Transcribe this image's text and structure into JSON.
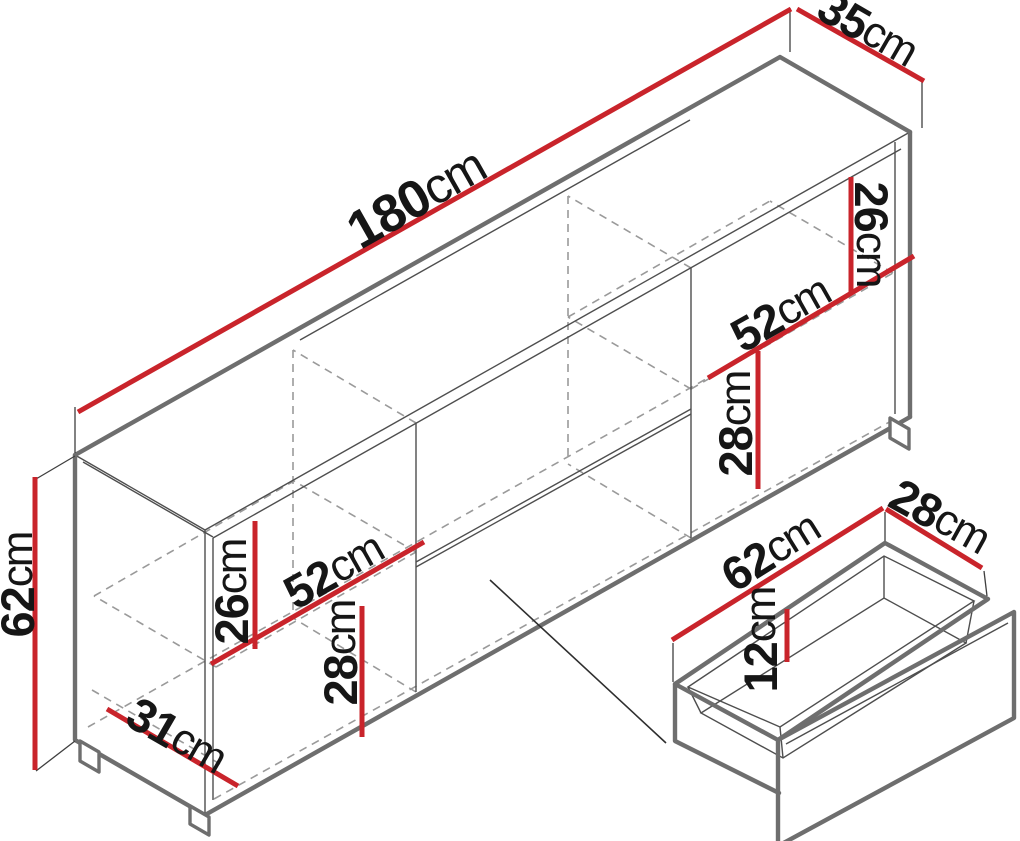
{
  "colors": {
    "dimension_line": "#c9242b",
    "cabinet_outline": "#6e6e6e",
    "hidden_line": "#9a9a9a",
    "label_text": "#161616",
    "background": "#ffffff"
  },
  "dims": {
    "cabinet_width": {
      "value": "180",
      "unit": "cm"
    },
    "cabinet_depth": {
      "value": "35",
      "unit": "cm"
    },
    "cabinet_height": {
      "value": "62",
      "unit": "cm"
    },
    "left_upper_compartment": {
      "value": "26",
      "unit": "cm"
    },
    "left_shelf_width": {
      "value": "52",
      "unit": "cm"
    },
    "left_lower_compartment": {
      "value": "28",
      "unit": "cm"
    },
    "base_inner_depth": {
      "value": "31",
      "unit": "cm"
    },
    "right_upper_compartment": {
      "value": "26",
      "unit": "cm"
    },
    "right_shelf_width": {
      "value": "52",
      "unit": "cm"
    },
    "right_lower_compartment": {
      "value": "28",
      "unit": "cm"
    },
    "drawer_width": {
      "value": "62",
      "unit": "cm"
    },
    "drawer_depth": {
      "value": "28",
      "unit": "cm"
    },
    "drawer_height": {
      "value": "12",
      "unit": "cm"
    }
  }
}
